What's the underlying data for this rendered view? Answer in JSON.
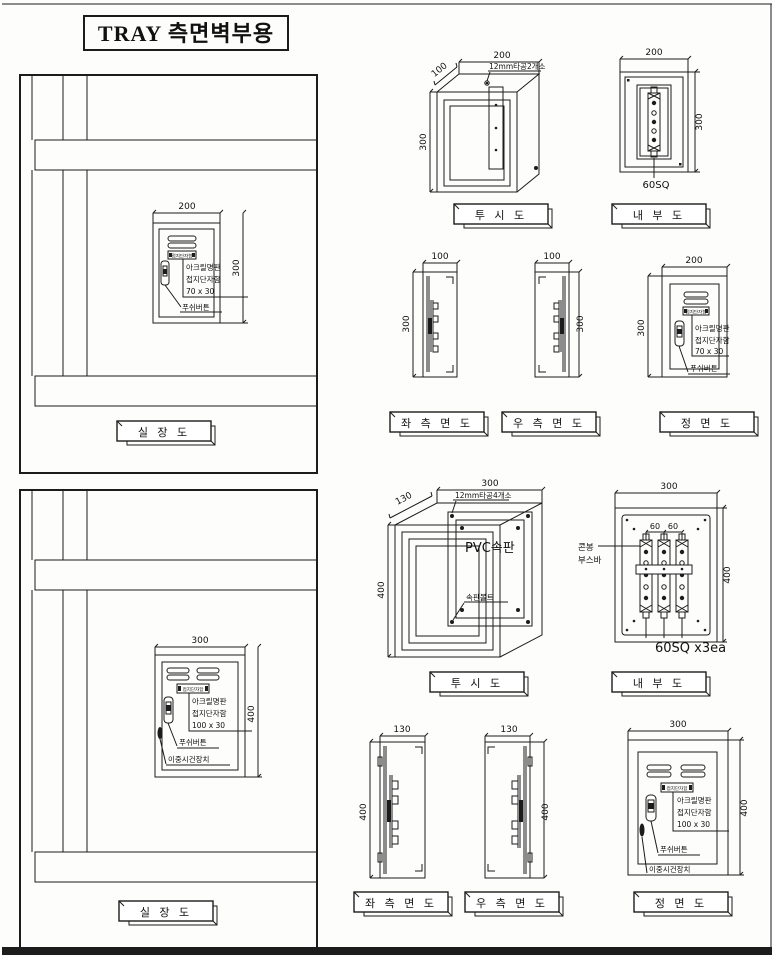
{
  "page": {
    "title": "TRAY 측면벽부용"
  },
  "captions": {
    "installation": "실 장 도",
    "perspective": "투 시 도",
    "internal": "내 부 도",
    "left_side": "좌 측 면 도",
    "right_side": "우 측 면 도",
    "front": "정 면 도"
  },
  "dims": {
    "d60": "60",
    "d100": "100",
    "d130": "130",
    "d200": "200",
    "d300": "300",
    "d400": "400"
  },
  "small_box": {
    "drill_note": "12mm타공2개소",
    "busbar_size": "60SQ",
    "nameplate_tag": "접지단자함",
    "acrylic_line1": "아크릴명판",
    "acrylic_line2": "접지단자함",
    "acrylic_line3": "70 x 30",
    "push_button": "푸쉬버튼"
  },
  "large_box": {
    "drill_note": "12mm타공4개소",
    "pvc_panel": "PVC속판",
    "panel_bolt": "속판볼트",
    "busbar_line1": "콘봉",
    "busbar_line2": "부스바",
    "busbar_size": "60SQ x3ea",
    "nameplate_tag": "접지단자함",
    "acrylic_line1": "아크릴명판",
    "acrylic_line2": "접지단자함",
    "acrylic_line3": "100 x 30",
    "push_button": "푸쉬버튼",
    "double_lock": "이중시건장치"
  }
}
